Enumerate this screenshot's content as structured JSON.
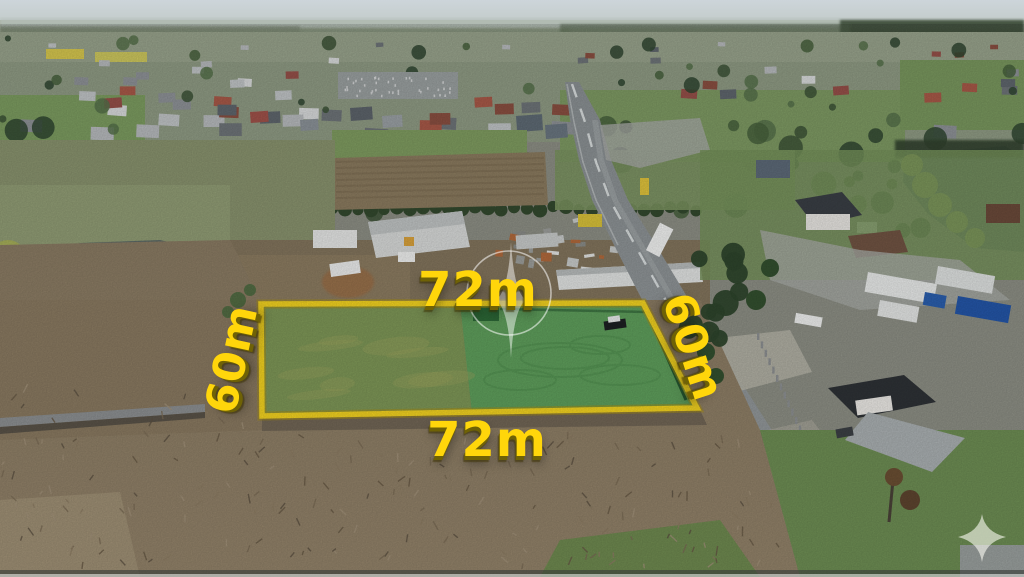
{
  "annotations": {
    "top_width_label": "72m",
    "bottom_width_label": "72m",
    "left_depth_label": "60m",
    "right_depth_label": "60m",
    "label_color": "#ffd60b",
    "plot_outline_color": "#f3d321"
  },
  "watermark": {
    "center_icon": "compass-star-circle-watermark",
    "corner_icon": "four-point-sparkle-watermark"
  },
  "scene": {
    "description_items": {
      "plot": "highlighted-green-plot",
      "road": "asphalt-road",
      "pond_left": "pond",
      "pond_right": "pond",
      "village": "village-skyline"
    }
  }
}
